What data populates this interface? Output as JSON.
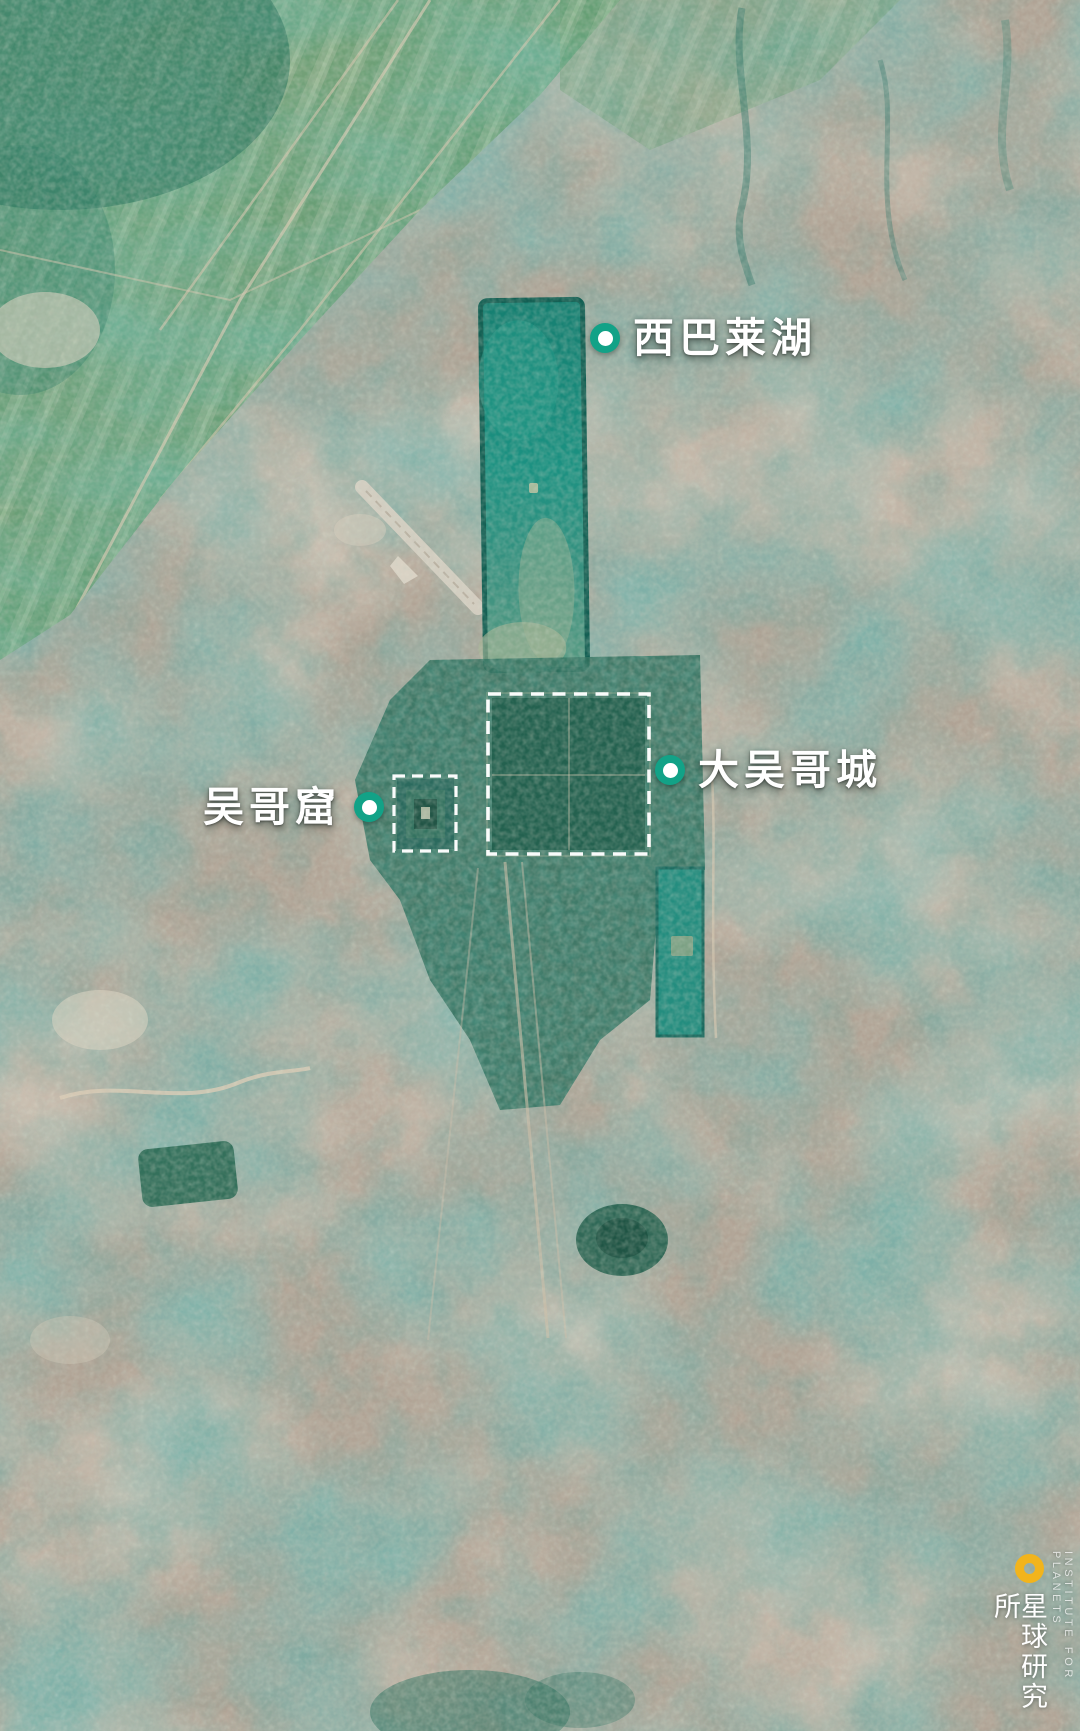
{
  "map_annotations": {
    "labels": {
      "west_baray": {
        "text": "西巴莱湖"
      },
      "angkor_thom": {
        "text": "大吴哥城"
      },
      "angkor_wat": {
        "text": "吴哥窟"
      }
    },
    "marker_color": "#12a287",
    "boundary_color": "#ffffff"
  },
  "watermark": {
    "logo_color": "#f2b41c",
    "name_cn": "星球研究所",
    "name_en": "INSTITUTE FOR PLANETS"
  }
}
